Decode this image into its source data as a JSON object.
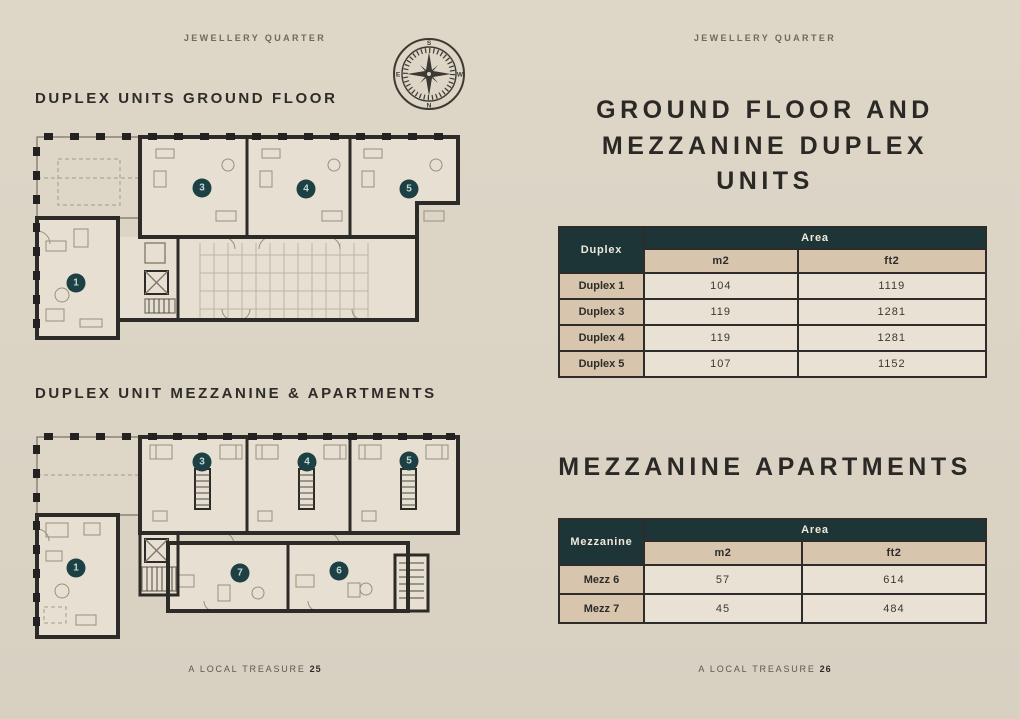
{
  "colors": {
    "page_background": "#dcd4c5",
    "accent_teal": "#1e3538",
    "tan_cell": "#d7c5ae",
    "cream_cell": "#e9e2d4",
    "ink": "#2e2c28"
  },
  "left_page": {
    "header": "JEWELLERY QUARTER",
    "section1_title": "DUPLEX UNITS GROUND FLOOR",
    "section2_title": "DUPLEX UNIT MEZZANINE & APARTMENTS",
    "footer_text": "A LOCAL TREASURE",
    "page_number": "25",
    "compass": {
      "letters": [
        "S",
        "W",
        "N",
        "E"
      ]
    },
    "plans": {
      "ground": {
        "badges": [
          {
            "label": "1"
          },
          {
            "label": "3"
          },
          {
            "label": "4"
          },
          {
            "label": "5"
          }
        ]
      },
      "mezzanine": {
        "badges": [
          {
            "label": "1"
          },
          {
            "label": "3"
          },
          {
            "label": "4"
          },
          {
            "label": "5"
          },
          {
            "label": "7"
          },
          {
            "label": "6"
          }
        ]
      }
    }
  },
  "right_page": {
    "header": "JEWELLERY QUARTER",
    "title1": "GROUND FLOOR AND MEZZANINE DUPLEX UNITS",
    "title2": "MEZZANINE APARTMENTS",
    "footer_text": "A LOCAL TREASURE",
    "page_number": "26",
    "duplex_table": {
      "corner": "Duplex",
      "area_header": "Area",
      "unit_headers": [
        "m2",
        "ft2"
      ],
      "rows": [
        {
          "label": "Duplex 1",
          "m2": "104",
          "ft2": "1119"
        },
        {
          "label": "Duplex 3",
          "m2": "119",
          "ft2": "1281"
        },
        {
          "label": "Duplex 4",
          "m2": "119",
          "ft2": "1281"
        },
        {
          "label": "Duplex 5",
          "m2": "107",
          "ft2": "1152"
        }
      ]
    },
    "mezzanine_table": {
      "corner": "Mezzanine",
      "area_header": "Area",
      "unit_headers": [
        "m2",
        "ft2"
      ],
      "rows": [
        {
          "label": "Mezz 6",
          "m2": "57",
          "ft2": "614"
        },
        {
          "label": "Mezz 7",
          "m2": "45",
          "ft2": "484"
        }
      ]
    }
  }
}
